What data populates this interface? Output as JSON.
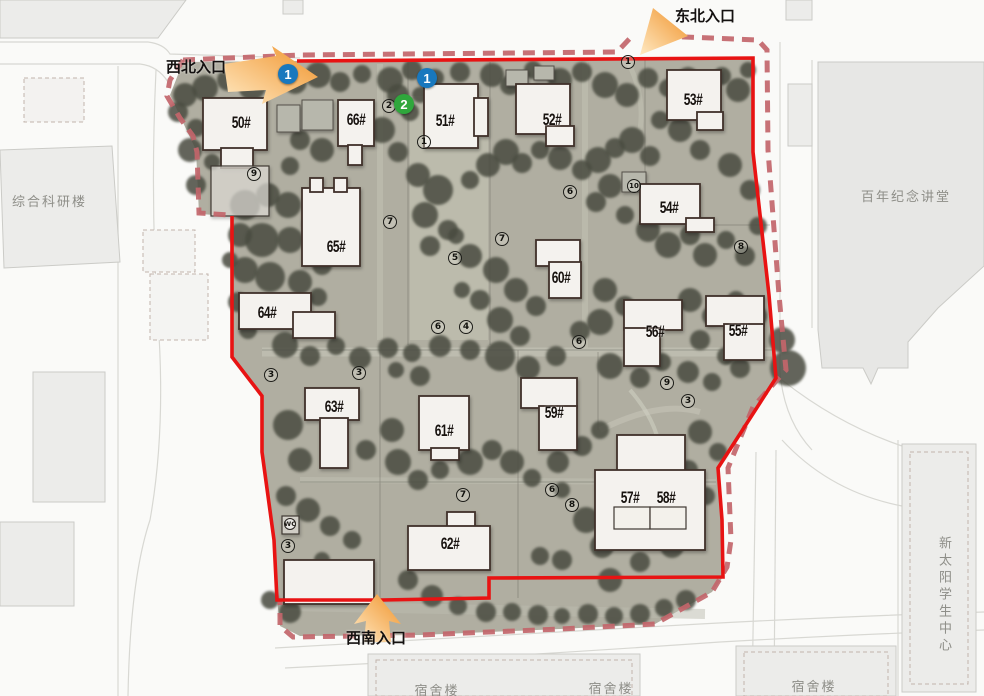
{
  "map": {
    "colors": {
      "boundary_solid": "#e81313",
      "boundary_dashed": "#c2656a",
      "ground": "#b0aea1",
      "tree": "#484c41",
      "building_fill": "#f4f2ee",
      "building_stroke": "#40312a",
      "roof_fill": "#b7b7ac",
      "marker_blue": "#1878be",
      "marker_green": "#2fa73c",
      "arrow_orange": "#f0932b",
      "outside_fill": "#ececea",
      "outside_stroke": "#cbcbc7",
      "label_gray": "#8e8e88"
    },
    "entrances": [
      {
        "id": "northwest",
        "label": "西北入口",
        "x": 166,
        "y": 56
      },
      {
        "id": "northeast",
        "label": "东北入口",
        "x": 675,
        "y": 5
      },
      {
        "id": "southwest",
        "label": "西南入口",
        "x": 346,
        "y": 627
      }
    ],
    "surroundings": [
      {
        "label": "综合科研楼",
        "x": 12,
        "y": 191
      },
      {
        "label": "百年纪念讲堂",
        "x": 861,
        "y": 186
      },
      {
        "label": "新太阳学生中心",
        "x": 934,
        "y": 536,
        "vertical": true
      },
      {
        "label": "宿舍楼",
        "x": 437,
        "y": 680,
        "center": true
      },
      {
        "label": "宿舍楼",
        "x": 611,
        "y": 678,
        "center": true
      },
      {
        "label": "宿舍楼",
        "x": 814,
        "y": 676,
        "center": true
      }
    ],
    "misc_labels": [
      {
        "label": "WC",
        "x": 290,
        "y": 524
      }
    ],
    "route_markers": [
      {
        "n": "1",
        "color": "blue",
        "x": 288,
        "y": 74
      },
      {
        "n": "1",
        "color": "blue",
        "x": 427,
        "y": 78
      },
      {
        "n": "2",
        "color": "green",
        "x": 404,
        "y": 104
      }
    ],
    "numbered_circles": [
      {
        "n": "9",
        "x": 254,
        "y": 174
      },
      {
        "n": "2",
        "x": 389,
        "y": 106
      },
      {
        "n": "1",
        "x": 424,
        "y": 142
      },
      {
        "n": "1",
        "x": 628,
        "y": 62
      },
      {
        "n": "7",
        "x": 390,
        "y": 222
      },
      {
        "n": "5",
        "x": 455,
        "y": 258
      },
      {
        "n": "6",
        "x": 570,
        "y": 192
      },
      {
        "n": "7",
        "x": 502,
        "y": 239
      },
      {
        "n": "10",
        "x": 634,
        "y": 186
      },
      {
        "n": "8",
        "x": 741,
        "y": 247
      },
      {
        "n": "6",
        "x": 438,
        "y": 327
      },
      {
        "n": "4",
        "x": 466,
        "y": 327
      },
      {
        "n": "6",
        "x": 579,
        "y": 342
      },
      {
        "n": "9",
        "x": 667,
        "y": 383
      },
      {
        "n": "3",
        "x": 688,
        "y": 401
      },
      {
        "n": "3",
        "x": 271,
        "y": 375
      },
      {
        "n": "3",
        "x": 359,
        "y": 373
      },
      {
        "n": "7",
        "x": 463,
        "y": 495
      },
      {
        "n": "6",
        "x": 552,
        "y": 490
      },
      {
        "n": "8",
        "x": 572,
        "y": 505
      },
      {
        "n": "3",
        "x": 288,
        "y": 546
      }
    ],
    "buildings": [
      {
        "number": "50#",
        "label_x": 241,
        "label_y": 122,
        "parts": [
          [
            203,
            98,
            64,
            52
          ],
          [
            221,
            148,
            32,
            20
          ]
        ]
      },
      {
        "number": "66#",
        "label_x": 356,
        "label_y": 119,
        "parts": [
          [
            338,
            100,
            36,
            46
          ],
          [
            348,
            145,
            14,
            20
          ]
        ]
      },
      {
        "number": "51#",
        "label_x": 445,
        "label_y": 120,
        "parts": [
          [
            424,
            84,
            54,
            64
          ],
          [
            474,
            98,
            14,
            38
          ]
        ]
      },
      {
        "number": "52#",
        "label_x": 552,
        "label_y": 119,
        "parts": [
          [
            516,
            84,
            54,
            50
          ],
          [
            546,
            126,
            28,
            20
          ]
        ]
      },
      {
        "number": "53#",
        "label_x": 693,
        "label_y": 99,
        "parts": [
          [
            667,
            70,
            54,
            50
          ],
          [
            697,
            112,
            26,
            18
          ]
        ]
      },
      {
        "number": "54#",
        "label_x": 669,
        "label_y": 207,
        "parts": [
          [
            640,
            184,
            60,
            40
          ],
          [
            686,
            218,
            28,
            14
          ]
        ]
      },
      {
        "number": "65#",
        "label_x": 336,
        "label_y": 246,
        "parts": [
          [
            302,
            188,
            58,
            78
          ],
          [
            310,
            178,
            13,
            14
          ],
          [
            334,
            178,
            13,
            14
          ]
        ]
      },
      {
        "number": "60#",
        "label_x": 561,
        "label_y": 277,
        "parts": [
          [
            536,
            240,
            44,
            26
          ],
          [
            549,
            262,
            32,
            36
          ]
        ]
      },
      {
        "number": "64#",
        "label_x": 267,
        "label_y": 312,
        "parts": [
          [
            239,
            293,
            72,
            36
          ],
          [
            293,
            312,
            42,
            26
          ]
        ]
      },
      {
        "number": "56#",
        "label_x": 655,
        "label_y": 331,
        "parts": [
          [
            624,
            300,
            58,
            30
          ],
          [
            624,
            328,
            36,
            38
          ]
        ]
      },
      {
        "number": "55#",
        "label_x": 738,
        "label_y": 330,
        "parts": [
          [
            706,
            296,
            58,
            30
          ],
          [
            724,
            324,
            40,
            36
          ]
        ]
      },
      {
        "number": "63#",
        "label_x": 334,
        "label_y": 406,
        "parts": [
          [
            305,
            388,
            54,
            32
          ],
          [
            320,
            418,
            28,
            50
          ]
        ]
      },
      {
        "number": "61#",
        "label_x": 444,
        "label_y": 430,
        "parts": [
          [
            419,
            396,
            50,
            54
          ],
          [
            431,
            448,
            28,
            12
          ]
        ]
      },
      {
        "number": "59#",
        "label_x": 554,
        "label_y": 412,
        "parts": [
          [
            521,
            378,
            56,
            30
          ],
          [
            539,
            406,
            38,
            44
          ]
        ]
      },
      {
        "number": "57#",
        "label_x": 630,
        "label_y": 497,
        "parts": [
          [
            617,
            435,
            68,
            38
          ],
          [
            595,
            470,
            110,
            80
          ]
        ]
      },
      {
        "number": "58#",
        "label_x": 666,
        "label_y": 497,
        "parts": []
      },
      {
        "number": "62#",
        "label_x": 450,
        "label_y": 543,
        "parts": [
          [
            447,
            512,
            28,
            16
          ],
          [
            408,
            526,
            82,
            44
          ]
        ]
      },
      {
        "number": "",
        "label_x": 0,
        "label_y": 0,
        "parts": [
          [
            284,
            560,
            90,
            44
          ]
        ]
      }
    ],
    "roof_structures": [
      [
        277,
        105,
        23,
        27
      ],
      [
        302,
        100,
        31,
        30
      ],
      [
        506,
        70,
        22,
        16
      ],
      [
        534,
        66,
        20,
        14
      ],
      [
        622,
        172,
        24,
        20
      ]
    ],
    "courts": [
      [
        211,
        166,
        58,
        50
      ],
      [
        614,
        507,
        36,
        22
      ],
      [
        650,
        507,
        36,
        22
      ],
      [
        282,
        516,
        17,
        18
      ]
    ],
    "boundary": {
      "solid_path": "M297,61 L753,58 L753,152 L769,295 L776,378 L718,468 L722,520 L723,577 L489,578 L489,598 L382,600 L277,600 L274,540 L262,452 L262,396 L232,357 L232,216",
      "dashed_paths": [
        "M183,60 L300,55 L617,52 L634,34",
        "M662,36 L758,40 L767,50 L768,150 L779,295 L786,370 L753,407 L728,468 L731,540 L727,567 L712,592 L655,624 L560,629 L420,635 L293,637 L280,626 L280,600",
        "M183,60 L170,80 L167,96 L180,118 L193,136 L197,152 L199,213 L230,215"
      ],
      "ground_path": "M297,61 L753,58 L753,152 L769,295 L776,378 L718,468 L722,520 L723,577 L712,592 L655,624 L560,629 L420,635 L300,636 L280,626 L277,600 L274,540 L262,452 L262,396 L232,357 L232,216 L199,214 L196,150 L170,95 L183,62 Z"
    },
    "trees": [
      [
        205,
        88,
        13
      ],
      [
        228,
        80,
        11
      ],
      [
        252,
        86,
        14
      ],
      [
        272,
        72,
        10
      ],
      [
        295,
        82,
        12
      ],
      [
        318,
        75,
        13
      ],
      [
        340,
        82,
        10
      ],
      [
        362,
        74,
        9
      ],
      [
        390,
        80,
        13
      ],
      [
        412,
        70,
        10
      ],
      [
        435,
        78,
        9
      ],
      [
        460,
        72,
        10
      ],
      [
        492,
        75,
        12
      ],
      [
        510,
        85,
        10
      ],
      [
        533,
        70,
        9
      ],
      [
        560,
        80,
        12
      ],
      [
        582,
        72,
        10
      ],
      [
        605,
        85,
        13
      ],
      [
        627,
        95,
        12
      ],
      [
        648,
        78,
        10
      ],
      [
        668,
        88,
        9
      ],
      [
        688,
        78,
        11
      ],
      [
        705,
        88,
        10
      ],
      [
        722,
        76,
        9
      ],
      [
        738,
        90,
        12
      ],
      [
        748,
        70,
        8
      ],
      [
        185,
        95,
        12
      ],
      [
        178,
        112,
        10
      ],
      [
        196,
        128,
        9
      ],
      [
        190,
        150,
        12
      ],
      [
        212,
        162,
        8
      ],
      [
        196,
        185,
        10
      ],
      [
        300,
        140,
        10
      ],
      [
        322,
        150,
        12
      ],
      [
        290,
        166,
        9
      ],
      [
        398,
        95,
        11
      ],
      [
        410,
        112,
        9
      ],
      [
        382,
        130,
        13
      ],
      [
        398,
        152,
        10
      ],
      [
        420,
        95,
        8
      ],
      [
        245,
        205,
        15
      ],
      [
        268,
        195,
        12
      ],
      [
        288,
        205,
        13
      ],
      [
        240,
        235,
        12
      ],
      [
        262,
        240,
        17
      ],
      [
        290,
        240,
        13
      ],
      [
        312,
        225,
        10
      ],
      [
        245,
        270,
        13
      ],
      [
        270,
        277,
        15
      ],
      [
        300,
        282,
        12
      ],
      [
        322,
        265,
        10
      ],
      [
        238,
        302,
        10
      ],
      [
        318,
        297,
        9
      ],
      [
        248,
        330,
        9
      ],
      [
        230,
        260,
        8
      ],
      [
        418,
        175,
        12
      ],
      [
        438,
        190,
        15
      ],
      [
        425,
        215,
        13
      ],
      [
        448,
        230,
        10
      ],
      [
        470,
        180,
        9
      ],
      [
        488,
        165,
        12
      ],
      [
        506,
        152,
        13
      ],
      [
        522,
        163,
        10
      ],
      [
        540,
        150,
        9
      ],
      [
        560,
        158,
        12
      ],
      [
        582,
        170,
        10
      ],
      [
        598,
        160,
        13
      ],
      [
        615,
        148,
        10
      ],
      [
        632,
        140,
        13
      ],
      [
        650,
        156,
        10
      ],
      [
        610,
        186,
        12
      ],
      [
        596,
        202,
        10
      ],
      [
        625,
        215,
        9
      ],
      [
        648,
        230,
        12
      ],
      [
        668,
        245,
        13
      ],
      [
        690,
        235,
        10
      ],
      [
        705,
        255,
        12
      ],
      [
        726,
        240,
        9
      ],
      [
        745,
        256,
        10
      ],
      [
        758,
        226,
        9
      ],
      [
        750,
        190,
        10
      ],
      [
        730,
        165,
        12
      ],
      [
        700,
        150,
        10
      ],
      [
        680,
        130,
        12
      ],
      [
        660,
        120,
        9
      ],
      [
        430,
        246,
        10
      ],
      [
        456,
        236,
        8
      ],
      [
        470,
        256,
        12
      ],
      [
        496,
        270,
        13
      ],
      [
        516,
        290,
        12
      ],
      [
        536,
        306,
        10
      ],
      [
        480,
        300,
        10
      ],
      [
        462,
        290,
        8
      ],
      [
        500,
        320,
        13
      ],
      [
        520,
        336,
        10
      ],
      [
        605,
        290,
        12
      ],
      [
        625,
        306,
        10
      ],
      [
        650,
        320,
        9
      ],
      [
        600,
        322,
        13
      ],
      [
        580,
        331,
        10
      ],
      [
        690,
        300,
        12
      ],
      [
        712,
        316,
        10
      ],
      [
        736,
        300,
        9
      ],
      [
        756,
        316,
        11
      ],
      [
        700,
        340,
        10
      ],
      [
        726,
        356,
        9
      ],
      [
        285,
        345,
        13
      ],
      [
        310,
        356,
        10
      ],
      [
        336,
        346,
        9
      ],
      [
        360,
        358,
        11
      ],
      [
        388,
        348,
        10
      ],
      [
        412,
        353,
        9
      ],
      [
        440,
        346,
        11
      ],
      [
        470,
        350,
        10
      ],
      [
        396,
        370,
        8
      ],
      [
        420,
        376,
        10
      ],
      [
        500,
        356,
        15
      ],
      [
        528,
        368,
        12
      ],
      [
        556,
        356,
        10
      ],
      [
        610,
        366,
        13
      ],
      [
        640,
        378,
        10
      ],
      [
        662,
        362,
        9
      ],
      [
        688,
        372,
        11
      ],
      [
        712,
        382,
        9
      ],
      [
        740,
        368,
        10
      ],
      [
        288,
        425,
        15
      ],
      [
        300,
        460,
        12
      ],
      [
        286,
        496,
        10
      ],
      [
        308,
        510,
        12
      ],
      [
        330,
        526,
        10
      ],
      [
        352,
        540,
        9
      ],
      [
        366,
        450,
        10
      ],
      [
        392,
        430,
        12
      ],
      [
        398,
        462,
        13
      ],
      [
        418,
        480,
        10
      ],
      [
        440,
        470,
        9
      ],
      [
        470,
        462,
        13
      ],
      [
        492,
        450,
        10
      ],
      [
        512,
        462,
        12
      ],
      [
        532,
        478,
        9
      ],
      [
        558,
        462,
        11
      ],
      [
        582,
        446,
        10
      ],
      [
        600,
        430,
        9
      ],
      [
        562,
        490,
        8
      ],
      [
        586,
        520,
        13
      ],
      [
        602,
        546,
        12
      ],
      [
        562,
        560,
        10
      ],
      [
        540,
        556,
        9
      ],
      [
        610,
        580,
        12
      ],
      [
        640,
        562,
        10
      ],
      [
        672,
        546,
        12
      ],
      [
        692,
        520,
        10
      ],
      [
        706,
        496,
        9
      ],
      [
        688,
        470,
        10
      ],
      [
        700,
        432,
        12
      ],
      [
        718,
        452,
        9
      ],
      [
        428,
        548,
        8
      ],
      [
        408,
        580,
        10
      ],
      [
        432,
        596,
        11
      ],
      [
        458,
        606,
        9
      ],
      [
        486,
        612,
        10
      ],
      [
        512,
        612,
        9
      ],
      [
        538,
        615,
        10
      ],
      [
        562,
        616,
        8
      ],
      [
        588,
        614,
        10
      ],
      [
        614,
        616,
        9
      ],
      [
        640,
        614,
        10
      ],
      [
        664,
        608,
        9
      ],
      [
        686,
        600,
        10
      ],
      [
        350,
        576,
        9
      ],
      [
        322,
        560,
        8
      ],
      [
        290,
        612,
        11
      ],
      [
        270,
        600,
        9
      ],
      [
        788,
        368,
        18
      ],
      [
        782,
        340,
        13
      ]
    ]
  }
}
